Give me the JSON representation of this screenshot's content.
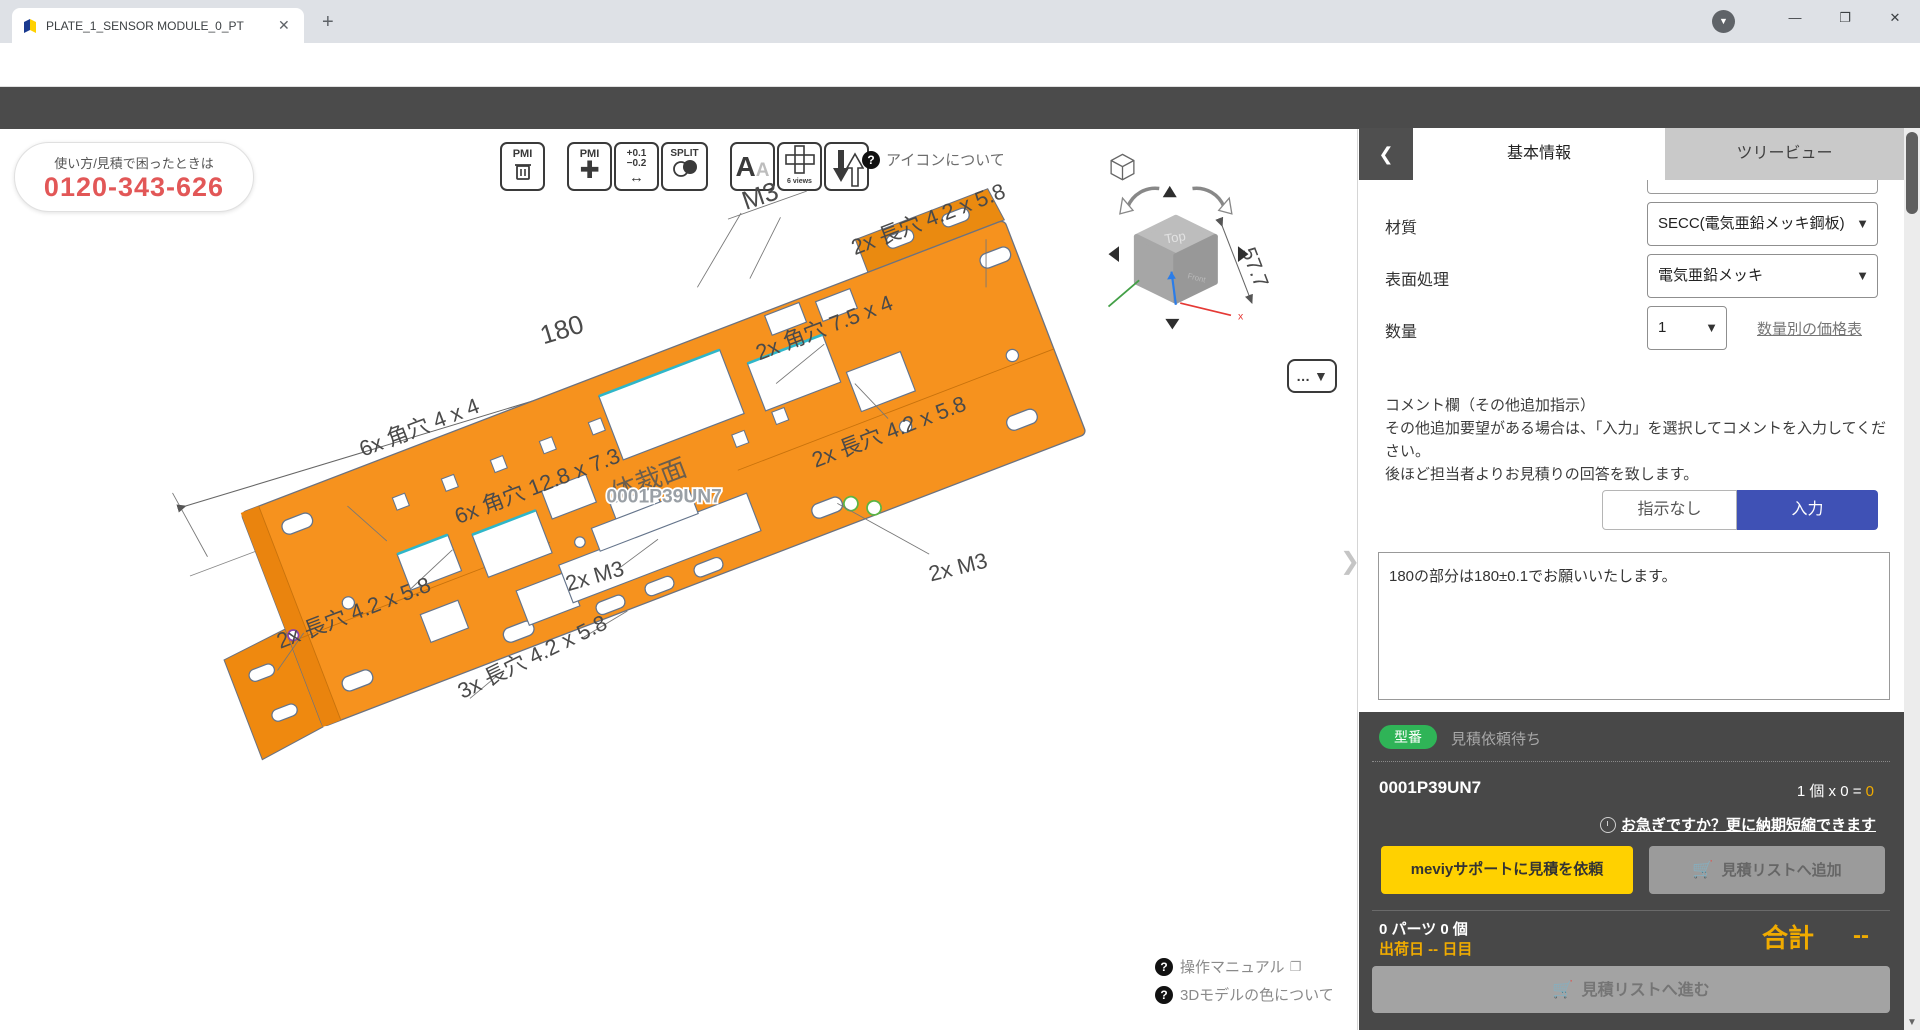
{
  "browser": {
    "tab_title": "PLATE_1_SENSOR MODULE_0_PT",
    "close_glyph": "✕",
    "new_tab_glyph": "+",
    "url": "meviy.misumi-ec.com/ja-jp/app/fa/3dview/0001OMVTDS/partsview/0001P39UN7?folderId=0001IJGEEJ&sortKey=createDateTime&sortOrder=desc",
    "avatar_text": "悠一"
  },
  "breadcrumb": {
    "items": [
      "プロジェクト一覧",
      "PTK",
      "PLATE_1_SENSOR MODULE_0_PTK.S...",
      "0001P39UN7",
      "板金部品"
    ]
  },
  "viewer": {
    "phone": {
      "line1": "使い方/見積で困ったときは",
      "line2": "0120-343-626"
    },
    "toolbar": {
      "pmi": "PMI",
      "tol_top": "+0.1",
      "tol_bottom": "−0.2",
      "split": "SPLIT",
      "letter_big": "A",
      "letter_small": "A",
      "six_views": "6 views",
      "icons_about": "アイコンについて",
      "qmark": "?"
    },
    "dims": {
      "d180": "180",
      "d577": "57.7"
    },
    "annotations": [
      {
        "text": "6x 角穴 4 x 4"
      },
      {
        "text": "6x 角穴 12.8 x 7.3"
      },
      {
        "text": "2x 角穴 7.5 x 4"
      },
      {
        "text": "2x 長穴 4.2 x 5.8"
      },
      {
        "text": "M3"
      },
      {
        "text": "2x 長穴 4.2 x 5.8"
      },
      {
        "text": "2x M3"
      },
      {
        "text": "2x 長穴 4.2 x 5.8"
      },
      {
        "text": "2x M3"
      },
      {
        "text": "3x 長穴 4.2 x 5.8"
      }
    ],
    "stamp": "体裁面",
    "watermark": "0001P39UN7",
    "cube": {
      "top": "Top",
      "front": "Front",
      "axis_x": "x"
    },
    "more_button": "… ▼",
    "edge_chevron": "❯",
    "help_link1": "操作マニュアル",
    "help_link2": "3Dモデルの色について"
  },
  "panel": {
    "back_glyph": "❮",
    "tabs": {
      "basic": "基本情報",
      "tree": "ツリービュー"
    },
    "fields": {
      "material_label": "材質",
      "material_value": "SECC(電気亜鉛メッキ鋼板)",
      "surface_label": "表面処理",
      "surface_value": "電気亜鉛メッキ",
      "qty_label": "数量",
      "qty_value": "1",
      "qty_link": "数量別の価格表",
      "chevron": "▼"
    },
    "comment": {
      "title": "コメント欄（その他追加指示）",
      "body1": "その他追加要望がある場合は、「入力」を選択してコメントを入力してください。",
      "body2": "後ほど担当者よりお見積りの回答を致します。",
      "toggle_off": "指示なし",
      "toggle_on": "入力",
      "textarea_value": "180の部分は180±0.1でお願いいたします。"
    },
    "order": {
      "badge": "型番",
      "status": "見積依頼待ち",
      "part_number": "0001P39UN7",
      "qty_expr": "1 個  x 0 =",
      "qty_total": "0",
      "rush": "お急ぎですか？更に納期短縮できます",
      "btn_support": "meviyサポートに見積を依頼",
      "btn_addlist": "見積リストへ追加",
      "parts_count": "0 パーツ 0 個",
      "ship": "出荷日 -- 日目",
      "total_label": "合計",
      "total_value": "--",
      "btn_proceed": "見積リストへ進む"
    }
  },
  "colors": {
    "plate_orange": "#F6921E",
    "meviy_yellow": "#FFD100",
    "accent_blue": "#3F51B5",
    "badge_green": "#2FB457",
    "highlight_yellow": "#F0AB00",
    "phone_red": "#E25757"
  }
}
